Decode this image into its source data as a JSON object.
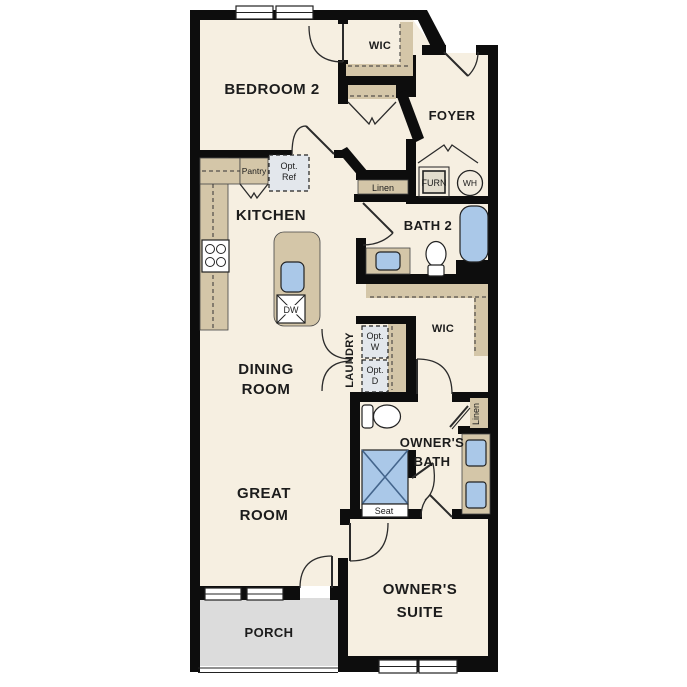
{
  "colors": {
    "floor": "#f6efe1",
    "wall": "#0d0d0d",
    "counter": "#d4c6a8",
    "fixture_blue": "#aac8e8",
    "porch": "#dcdcdc",
    "optional": "#e3e7ec",
    "opt_ref_gray": "#e6e6e6"
  },
  "rooms": {
    "bedroom2": "BEDROOM 2",
    "wic_top": "WIC",
    "foyer": "FOYER",
    "kitchen": "KITCHEN",
    "bath2": "BATH 2",
    "dining_line1": "DINING",
    "dining_line2": "ROOM",
    "laundry": "LAUNDRY",
    "wic_mid": "WIC",
    "owners_bath_line1": "OWNER'S",
    "owners_bath_line2": "BATH",
    "great_line1": "GREAT",
    "great_line2": "ROOM",
    "suite_line1": "OWNER'S",
    "suite_line2": "SUITE",
    "porch": "PORCH"
  },
  "fixtures": {
    "pantry": "Pantry",
    "opt_ref_line1": "Opt.",
    "opt_ref_line2": "Ref",
    "linen_hall": "Linen",
    "furnace": "FURN",
    "water_heater": "WH",
    "dishwasher": "DW",
    "opt_washer_line1": "Opt.",
    "opt_washer_line2": "W",
    "opt_dryer_line1": "Opt.",
    "opt_dryer_line2": "D",
    "linen_owner": "Linen",
    "seat": "Seat"
  }
}
